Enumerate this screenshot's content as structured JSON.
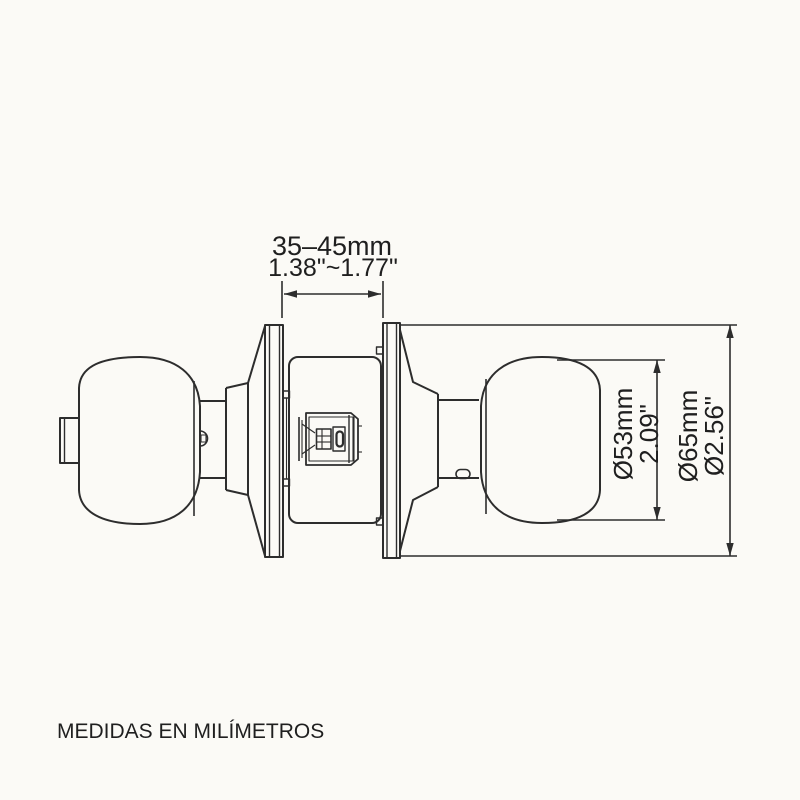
{
  "colors": {
    "background": "#fbfaf6",
    "line": "#2d2d2d",
    "text": "#1f1f1f"
  },
  "diagram": {
    "type": "technical-drawing",
    "subject": "door knob lockset, side view",
    "dimensions": {
      "door_thickness": {
        "mm": "35–45mm",
        "inches": "1.38\"~1.77\""
      },
      "knob_diameter": {
        "mm": "Ø53mm",
        "inches": "2.09\""
      },
      "rose_diameter": {
        "mm": "Ø65mm",
        "inches": "Ø2.56\""
      }
    }
  },
  "footer": {
    "note": "MEDIDAS EN MILÍMETROS"
  }
}
